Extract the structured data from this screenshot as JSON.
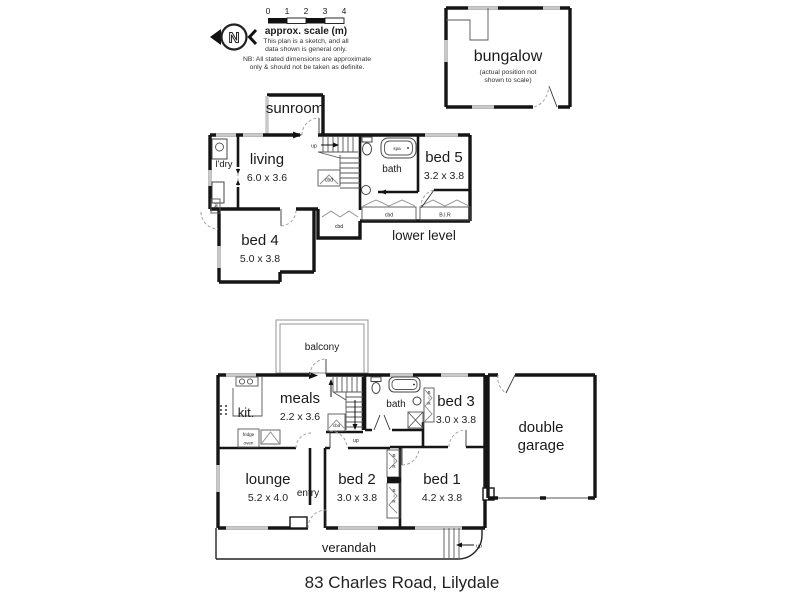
{
  "title": "83 Charles Road, Lilydale",
  "legend": {
    "north": "N",
    "ticks": [
      "0",
      "1",
      "2",
      "3",
      "4"
    ],
    "caption": "approx. scale (m)",
    "note1": "This plan is a sketch, and all",
    "note2": "data shown is general only.",
    "nb1": "NB: All stated dimensions are approximate",
    "nb2": "only & should not be taken as definite."
  },
  "bungalow": {
    "name": "bungalow",
    "note1": "(actual position not",
    "note2": "shown to scale)"
  },
  "upper": {
    "caption": "lower level",
    "sunroom": "sunroom",
    "laundry": "l'dry",
    "living": {
      "name": "living",
      "dims": "6.0 x 3.6"
    },
    "bath": {
      "name": "bath",
      "spa": "spa"
    },
    "bed5": {
      "name": "bed 5",
      "dims": "3.2 x 3.8"
    },
    "bed4": {
      "name": "bed 4",
      "dims": "5.0 x 3.8"
    },
    "labels": {
      "up": "up",
      "cbd": "cbd",
      "bir": "B.I.R"
    }
  },
  "ground": {
    "balcony": "balcony",
    "kitchen": {
      "name": "kit.",
      "fridge": "fridge",
      "oven": "oven"
    },
    "meals": {
      "name": "meals",
      "dims": "2.2 x 3.6"
    },
    "bath": "bath",
    "bed3": {
      "name": "bed 3",
      "dims": "3.0 x 3.8"
    },
    "garage": {
      "line1": "double",
      "line2": "garage"
    },
    "lounge": {
      "name": "lounge",
      "dims": "5.2 x 4.0"
    },
    "entry": "entry",
    "bed2": {
      "name": "bed 2",
      "dims": "3.0 x 3.8"
    },
    "bed1": {
      "name": "bed 1",
      "dims": "4.2 x 3.8"
    },
    "verandah": "verandah",
    "labels": {
      "up": "up",
      "cbd": "cbd",
      "bir": "BIR"
    }
  }
}
